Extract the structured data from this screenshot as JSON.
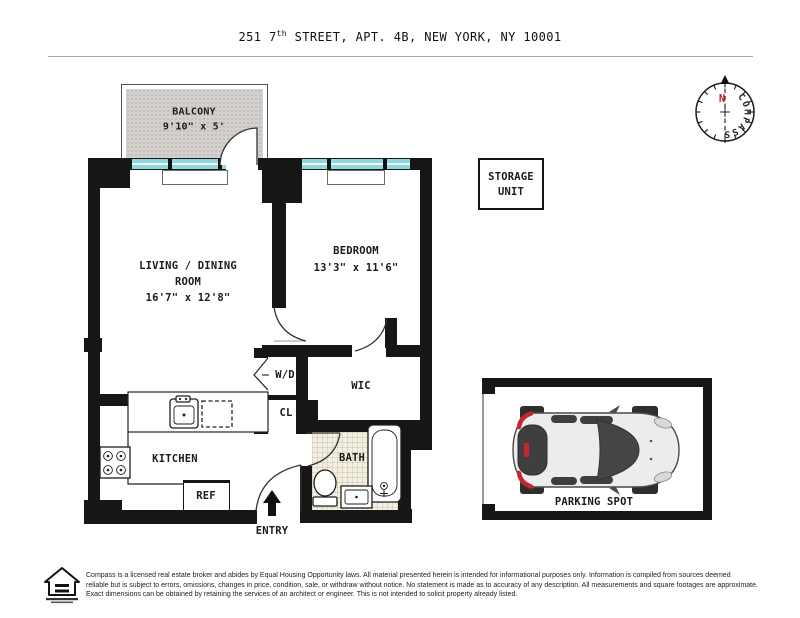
{
  "title": {
    "pre": "251 7",
    "sup": "th",
    "post": " STREET, APT. 4B, NEW YORK, NY 10001"
  },
  "rooms": {
    "balcony": {
      "name": "BALCONY",
      "dims": "9'10\" x 5'"
    },
    "living": {
      "line1": "LIVING / DINING",
      "line2": "ROOM",
      "dims": "16'7\" x 12'8\""
    },
    "bedroom": {
      "name": "BEDROOM",
      "dims": "13'3\" x 11'6\""
    },
    "wic": {
      "name": "WIC"
    },
    "bath": {
      "name": "BATH"
    },
    "kitchen": {
      "name": "KITCHEN"
    },
    "wd": {
      "name": "W/D"
    },
    "cl": {
      "name": "CL"
    },
    "entry": {
      "name": "ENTRY"
    }
  },
  "fixtures": {
    "ref": "REF",
    "dw": "DW"
  },
  "storage": {
    "line1": "STORAGE",
    "line2": "UNIT"
  },
  "parking": {
    "label": "PARKING SPOT"
  },
  "compass": {
    "letters": "COMPASS",
    "north": "N"
  },
  "disclaimer": {
    "line1": "Compass is a licensed real estate broker and abides by Equal Housing Opportunity laws. All material presented herein is intended for informational purposes only. Information is compiled from sources deemed",
    "line2": "reliable but is subject to errors, omissions, changes in price, condition, sale, or withdraw without notice. No statement is made as to accuracy of any description. All measurements and square footages are approximate.",
    "line3": "Exact dimensions can be obtained by retaining the services of an architect or engineer. This is not intended to solicit property already listed."
  },
  "colors": {
    "wall": "#161616",
    "window": "#8ed8e2",
    "balcony_floor": "#d3d0cd",
    "bath_floor": "#f3efe2",
    "accent_red": "#c5262d",
    "car_body": "#ececec",
    "car_glass": "#454545"
  }
}
